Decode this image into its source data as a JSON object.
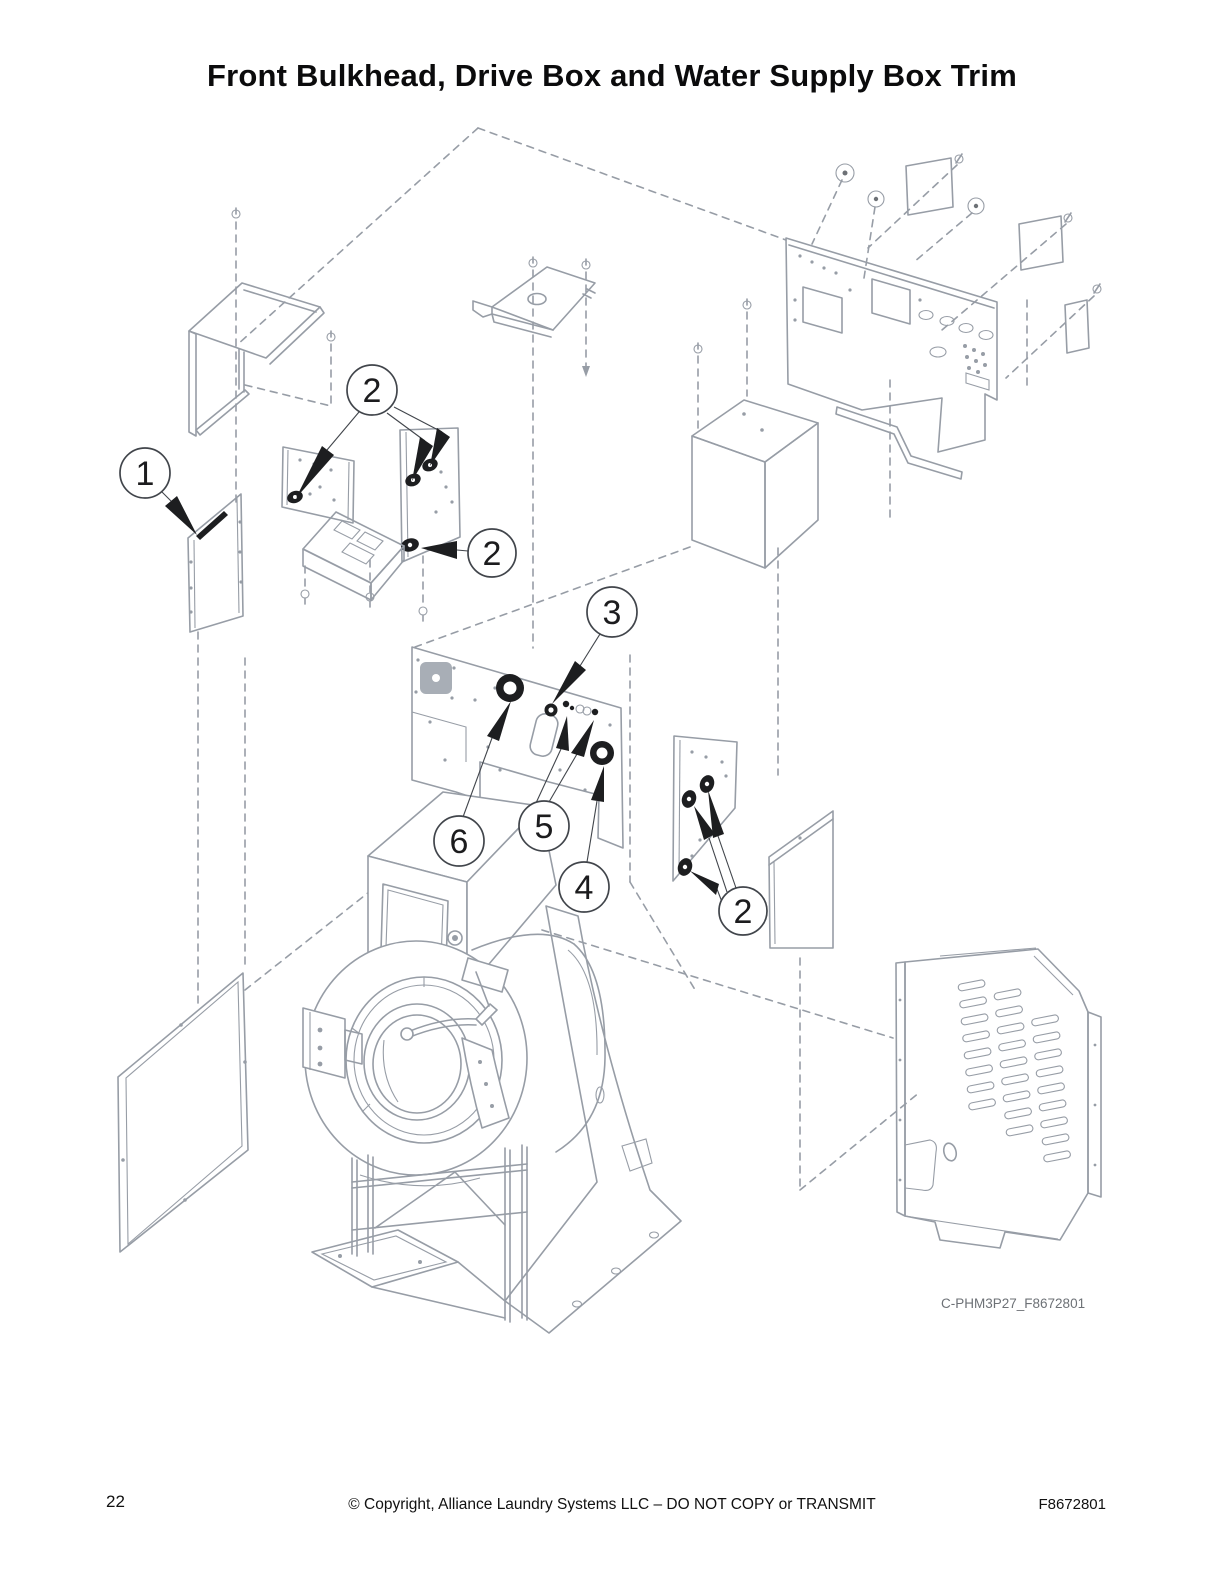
{
  "page": {
    "title": "Front Bulkhead, Drive Box and Water Supply Box Trim",
    "page_number": "22",
    "copyright": "© Copyright, Alliance Laundry Systems LLC – DO NOT COPY or TRANSMIT",
    "document_number": "F8672801"
  },
  "diagram": {
    "figure_code": "C-PHM3P27_F8672801",
    "type": "exploded-parts-diagram",
    "subject": "washer front bulkhead, drive box and water supply box trim",
    "callouts": [
      {
        "id": "callout-1",
        "number": "1"
      },
      {
        "id": "callout-2-top",
        "number": "2"
      },
      {
        "id": "callout-2-supply-box",
        "number": "2"
      },
      {
        "id": "callout-3",
        "number": "3"
      },
      {
        "id": "callout-4",
        "number": "4"
      },
      {
        "id": "callout-5",
        "number": "5"
      },
      {
        "id": "callout-6",
        "number": "6"
      },
      {
        "id": "callout-2-right",
        "number": "2"
      }
    ],
    "colors": {
      "line": "#979da6",
      "dark_parts": "#1d1e20",
      "callout_stroke": "#41454b",
      "text": "#111111",
      "figure_label": "#6d7176"
    }
  }
}
